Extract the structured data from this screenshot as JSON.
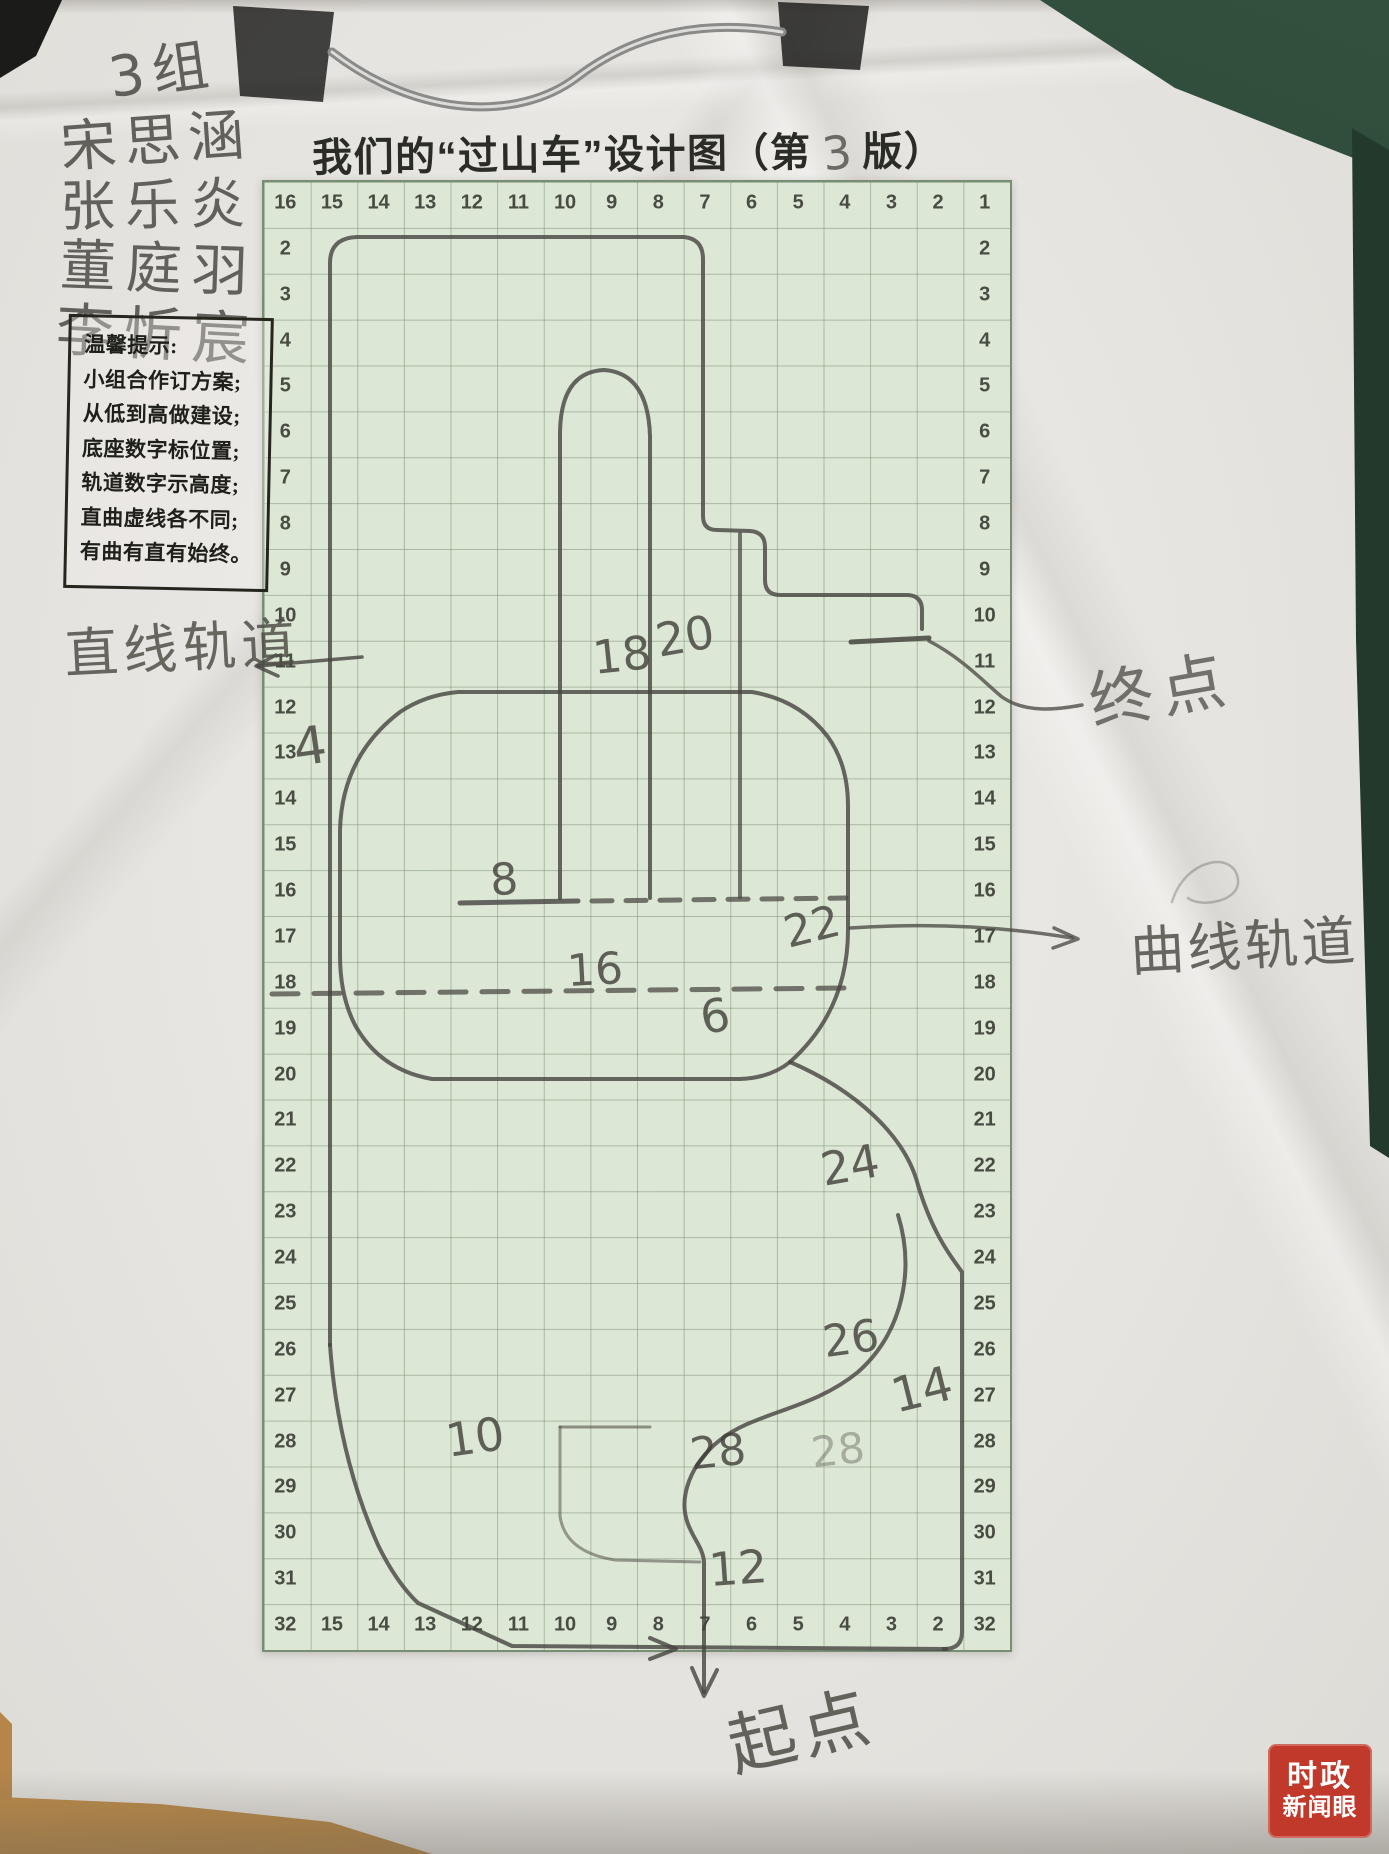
{
  "title": {
    "part1": "我们的“过山车”设计图（第",
    "version": "3",
    "part2": "版）"
  },
  "names": [
    "3组",
    "宋思涵",
    "张乐炎",
    "董庭羽",
    "李忻宸"
  ],
  "tips": {
    "heading": "温馨提示:",
    "lines": [
      "小组合作订方案;",
      "从低到高做建设;",
      "底座数字标位置;",
      "轨道数字示高度;",
      "直曲虚线各不同;",
      "有曲有直有始终。"
    ]
  },
  "labels": {
    "straight_track": "直线轨道",
    "end_point": "终点",
    "curved_track": "曲线轨道",
    "start_point": "起点"
  },
  "grid": {
    "top_row": [
      "16",
      "15",
      "14",
      "13",
      "12",
      "11",
      "10",
      "9",
      "8",
      "7",
      "6",
      "5",
      "4",
      "3",
      "2",
      "1"
    ],
    "bottom_row": [
      "32",
      "15",
      "14",
      "13",
      "12",
      "11",
      "10",
      "9",
      "8",
      "7",
      "6",
      "5",
      "4",
      "3",
      "2",
      "32"
    ],
    "left_col": [
      "2",
      "3",
      "4",
      "5",
      "6",
      "7",
      "8",
      "9",
      "10",
      "11",
      "12",
      "13",
      "14",
      "15",
      "16",
      "17",
      "18",
      "19",
      "20",
      "21",
      "22",
      "23",
      "24",
      "25",
      "26",
      "27",
      "28",
      "29",
      "30",
      "31"
    ],
    "right_col": [
      "2",
      "3",
      "4",
      "5",
      "6",
      "7",
      "8",
      "9",
      "10",
      "11",
      "12",
      "13",
      "14",
      "15",
      "16",
      "17",
      "18",
      "19",
      "20",
      "21",
      "22",
      "23",
      "24",
      "25",
      "26",
      "27",
      "28",
      "29",
      "30",
      "31"
    ]
  },
  "track_numbers": [
    {
      "t": "18",
      "x": 622,
      "y": 655,
      "s": 46,
      "r": -6
    },
    {
      "t": "20",
      "x": 685,
      "y": 636,
      "s": 46,
      "r": -10
    },
    {
      "t": "8",
      "x": 504,
      "y": 880,
      "s": 44,
      "r": -5
    },
    {
      "t": "4",
      "x": 310,
      "y": 747,
      "s": 52,
      "r": -8
    },
    {
      "t": "22",
      "x": 812,
      "y": 927,
      "s": 44,
      "r": -14
    },
    {
      "t": "16",
      "x": 595,
      "y": 970,
      "s": 44,
      "r": -3
    },
    {
      "t": "6",
      "x": 715,
      "y": 1016,
      "s": 46,
      "r": -10
    },
    {
      "t": "24",
      "x": 850,
      "y": 1165,
      "s": 46,
      "r": -10
    },
    {
      "t": "26",
      "x": 851,
      "y": 1339,
      "s": 44,
      "r": -8
    },
    {
      "t": "14",
      "x": 922,
      "y": 1390,
      "s": 48,
      "r": -14
    },
    {
      "t": "28",
      "x": 718,
      "y": 1452,
      "s": 44,
      "r": -6
    },
    {
      "t": "28",
      "x": 838,
      "y": 1450,
      "s": 42,
      "r": -6,
      "o": 0.35
    },
    {
      "t": "10",
      "x": 475,
      "y": 1437,
      "s": 46,
      "r": -8
    },
    {
      "t": "12",
      "x": 738,
      "y": 1568,
      "s": 46,
      "r": -4
    }
  ],
  "watermark": {
    "line1": "时政",
    "line2": "新闻眼",
    "bg": "#c0392b"
  },
  "colors": {
    "pencil": "#45443e",
    "grid_green": "#dde7d6",
    "board_green": "#2e4a39",
    "wood": "#b5854a"
  },
  "sketch": {
    "paths": [
      {
        "d": "M233,6 L334,12 L323,102 L240,96 Z",
        "fill": "#161615",
        "name": "clip-pad-left"
      },
      {
        "d": "M778,2 L869,6 L860,70 L783,66 Z",
        "fill": "#141413",
        "name": "clip-pad-right"
      },
      {
        "d": "M332,52 C420,120 520,120 576,78 C638,30 710,20 782,32",
        "w": 9,
        "o": 1,
        "c": "#8a8a88",
        "name": "clip-wire"
      },
      {
        "d": "M332,52 C420,120 520,120 576,78 C638,30 710,20 782,32",
        "w": 3,
        "o": 1,
        "c": "#dcdcda",
        "name": "clip-wire-highlight"
      },
      {
        "d": "M330,1345 L330,263 Q330,238 357,237 L684,237 Q703,239 703,259 L703,516 Q703,530 717,530 L750,531 Q765,532 765,547 L765,580 Q765,595 780,595 L908,595 Q922,596 922,610 L922,629",
        "w": 4,
        "o": 0.8,
        "name": "outer-loop"
      },
      {
        "d": "M851,642 L929,638",
        "w": 5,
        "o": 0.85,
        "name": "end-bar"
      },
      {
        "d": "M560,898 L560,432 Q561,372 604,370 Q648,373 650,436 L650,898",
        "w": 4,
        "o": 0.8,
        "name": "center-hairpin"
      },
      {
        "d": "M740,534 L740,897",
        "w": 4,
        "o": 0.72,
        "name": "center-rail"
      },
      {
        "d": "M458,692 L752,692 Q800,700 828,737 Q848,765 848,806 L848,930 Q848,1010 790,1062 Q770,1078 740,1079 L432,1079 Q380,1070 355,1025 Q340,996 340,955 L340,830 Q342,756 400,712 Q425,695 458,692",
        "w": 4,
        "o": 0.8,
        "name": "capsule-loop"
      },
      {
        "d": "M460,903 L578,901",
        "w": 5,
        "o": 0.8,
        "name": "rail-solid"
      },
      {
        "d": "M592,901 L846,898",
        "w": 5,
        "o": 0.72,
        "dash": "20 14",
        "name": "rail-dashed"
      },
      {
        "d": "M272,994 L846,988",
        "w": 5,
        "o": 0.72,
        "dash": "26 16",
        "name": "rail-dashed-2"
      },
      {
        "d": "M330,1345 Q338,1455 378,1545 Q396,1582 418,1603 L512,1646 L946,1649",
        "w": 4,
        "o": 0.8,
        "name": "bottom-run"
      },
      {
        "d": "M790,1062 C855,1090 905,1135 918,1185 C933,1235 952,1258 962,1272 L962,1632 Q962,1649 944,1649",
        "w": 4,
        "o": 0.8,
        "name": "right-descent"
      },
      {
        "d": "M898,1215 C915,1270 903,1332 858,1372 C812,1410 755,1412 720,1440 C690,1464 678,1498 688,1524 C694,1540 703,1548 704,1562 L704,1692",
        "w": 4,
        "o": 0.8,
        "name": "lower-s-curve"
      },
      {
        "d": "M560,1427 L650,1427",
        "w": 3,
        "o": 0.55,
        "name": "inner-bracket-top"
      },
      {
        "d": "M560,1427 L560,1516 Q565,1552 615,1560 L700,1562",
        "w": 3,
        "o": 0.5,
        "name": "inner-bracket-side"
      },
      {
        "d": "M650,1638 L676,1649 L650,1659",
        "w": 4,
        "o": 0.8,
        "name": "bottom-arrowhead"
      },
      {
        "d": "M692,1668 L704,1696 L717,1670",
        "w": 4,
        "o": 0.8,
        "name": "start-arrowhead"
      },
      {
        "d": "M362,657 L258,666",
        "w": 3.5,
        "o": 0.8,
        "name": "straight-callout"
      },
      {
        "d": "M276,655 L256,666 L278,676",
        "w": 3.5,
        "o": 0.8,
        "name": "straight-callout-arrowhead"
      },
      {
        "d": "M929,641 C962,658 985,683 1002,697 C1025,713 1055,710 1082,705",
        "w": 3.5,
        "o": 0.75,
        "name": "end-callout"
      },
      {
        "d": "M850,928 C940,922 1010,928 1072,938",
        "w": 3.5,
        "o": 0.75,
        "name": "curve-callout"
      },
      {
        "d": "M1054,928 L1078,939 L1053,948",
        "w": 3.5,
        "o": 0.75,
        "name": "curve-callout-arrowhead"
      },
      {
        "d": "M1172,902 C1185,858 1235,850 1238,880 C1240,902 1200,908 1188,898",
        "w": 2.5,
        "o": 0.3,
        "name": "stray-scribble"
      }
    ]
  }
}
